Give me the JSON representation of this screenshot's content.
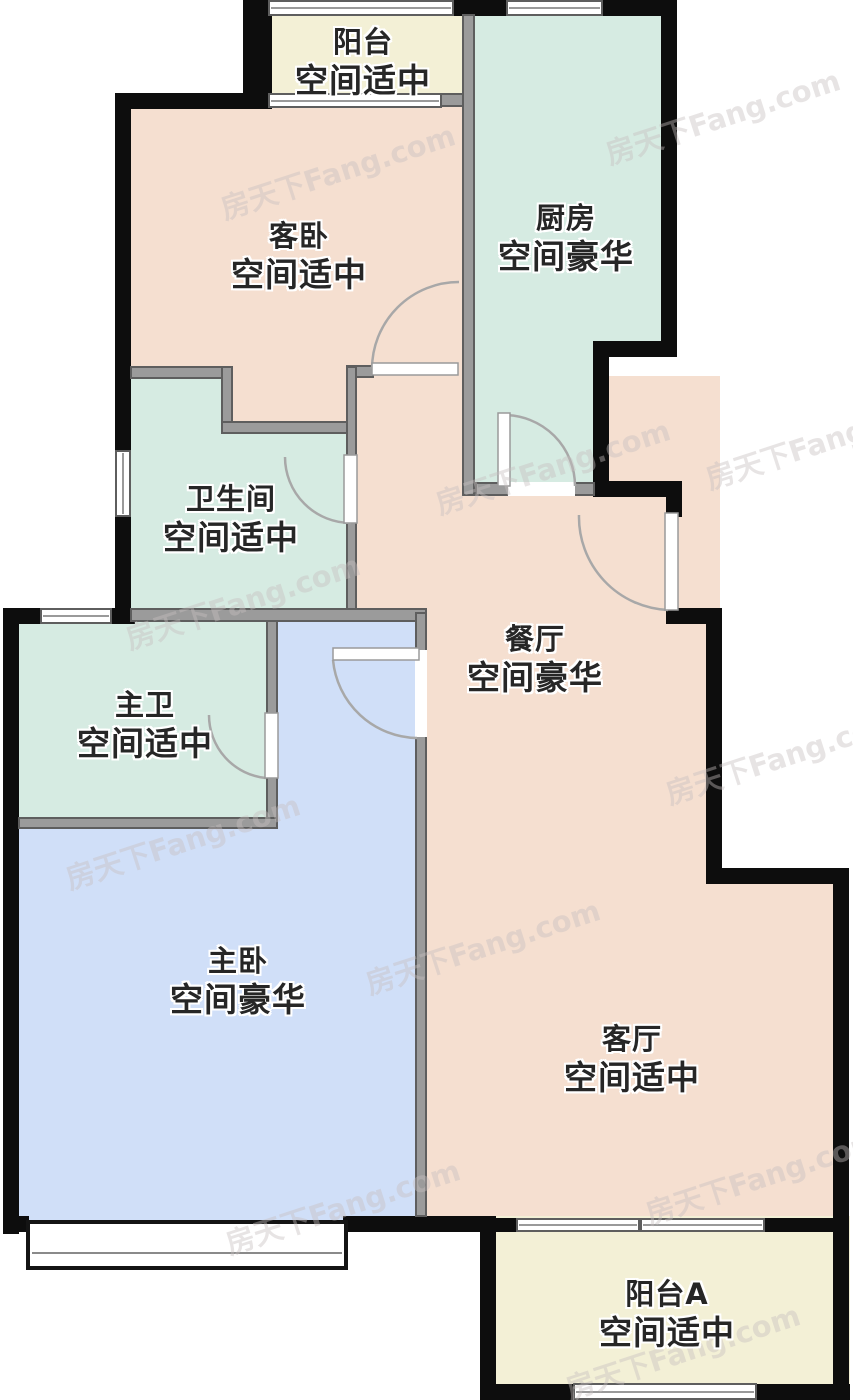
{
  "palette": {
    "peach": "#f5dfd0",
    "mint": "#d6ebe2",
    "cream": "#f3f0d6",
    "blue": "#d0dff8",
    "wall_exterior": "#0d0d0d",
    "wall_interior": "#9b9b9b",
    "label_text": "#262626",
    "door_arc": "#a8a8a8"
  },
  "canvas": {
    "width": 853,
    "height": 1400
  },
  "rooms": [
    {
      "id": "guest-bedroom",
      "color": "peach",
      "rects": [
        [
          115,
          93,
          360,
          401
        ]
      ],
      "label": {
        "l1": "客卧",
        "l2": "空间适中",
        "x": 299,
        "y": 257
      }
    },
    {
      "id": "dining-room",
      "color": "peach",
      "rects": [
        [
          347,
          376,
          373,
          506
        ],
        [
          415,
          612,
          305,
          620
        ]
      ],
      "label": {
        "l1": "餐厅",
        "l2": "空间豪华",
        "x": 535,
        "y": 660
      }
    },
    {
      "id": "living-room",
      "color": "peach",
      "rects": [
        [
          706,
          868,
          142,
          364
        ]
      ],
      "label": {
        "l1": "客厅",
        "l2": "空间适中",
        "x": 632,
        "y": 1060
      }
    },
    {
      "id": "master-bedroom",
      "color": "blue",
      "rects": [
        [
          18,
          608,
          408,
          624
        ]
      ],
      "label": {
        "l1": "主卧",
        "l2": "空间豪华",
        "x": 238,
        "y": 982
      }
    },
    {
      "id": "kitchen",
      "color": "mint",
      "rects": [
        [
          462,
          16,
          213,
          339
        ],
        [
          462,
          342,
          145,
          152
        ]
      ],
      "label": {
        "l1": "厨房",
        "l2": "空间豪华",
        "x": 566,
        "y": 239
      }
    },
    {
      "id": "bathroom",
      "color": "mint",
      "rects": [
        [
          115,
          366,
          117,
          71
        ],
        [
          115,
          427,
          242,
          195
        ]
      ],
      "label": {
        "l1": "卫生间",
        "l2": "空间适中",
        "x": 231,
        "y": 520
      }
    },
    {
      "id": "master-bathroom",
      "color": "mint",
      "rects": [
        [
          18,
          608,
          260,
          220
        ]
      ],
      "label": {
        "l1": "主卫",
        "l2": "空间适中",
        "x": 145,
        "y": 726
      }
    },
    {
      "id": "balcony",
      "color": "cream",
      "rects": [
        [
          245,
          0,
          230,
          107
        ]
      ],
      "label": {
        "l1": "阳台",
        "l2": "空间适中",
        "x": 363,
        "y": 63
      }
    },
    {
      "id": "balcony-a",
      "color": "cream",
      "rects": [
        [
          480,
          1216,
          370,
          184
        ]
      ],
      "label": {
        "l1": "阳台A",
        "l2": "空间适中",
        "x": 667,
        "y": 1315
      }
    }
  ],
  "walls": {
    "exterior": [
      [
        243,
        0,
        29,
        107
      ],
      [
        452,
        0,
        58,
        16
      ],
      [
        601,
        0,
        76,
        16
      ],
      [
        661,
        0,
        16,
        357
      ],
      [
        593,
        341,
        84,
        16
      ],
      [
        593,
        341,
        16,
        156
      ],
      [
        593,
        481,
        89,
        16
      ],
      [
        666,
        493,
        16,
        24
      ],
      [
        666,
        608,
        56,
        16
      ],
      [
        706,
        608,
        16,
        276
      ],
      [
        706,
        868,
        143,
        16
      ],
      [
        833,
        868,
        16,
        532
      ],
      [
        115,
        93,
        157,
        16
      ],
      [
        115,
        93,
        16,
        361
      ],
      [
        115,
        515,
        16,
        97
      ],
      [
        3,
        608,
        16,
        626
      ],
      [
        3,
        608,
        39,
        16
      ],
      [
        110,
        608,
        25,
        16
      ],
      [
        3,
        1216,
        26,
        16
      ],
      [
        343,
        1216,
        153,
        16
      ],
      [
        480,
        1216,
        16,
        184
      ],
      [
        480,
        1384,
        102,
        16
      ],
      [
        755,
        1384,
        95,
        16
      ],
      [
        495,
        1218,
        23,
        14
      ],
      [
        763,
        1218,
        72,
        14
      ]
    ],
    "interior": [
      [
        462,
        14,
        13,
        482
      ],
      [
        440,
        93,
        24,
        14
      ],
      [
        130,
        366,
        102,
        13
      ],
      [
        221,
        366,
        12,
        66
      ],
      [
        221,
        421,
        134,
        13
      ],
      [
        346,
        365,
        28,
        13
      ],
      [
        346,
        366,
        11,
        93
      ],
      [
        346,
        521,
        11,
        99
      ],
      [
        130,
        608,
        297,
        14
      ],
      [
        415,
        612,
        12,
        43
      ],
      [
        415,
        735,
        12,
        482
      ],
      [
        266,
        620,
        12,
        97
      ],
      [
        266,
        776,
        12,
        53
      ],
      [
        18,
        817,
        260,
        12
      ],
      [
        475,
        482,
        35,
        14
      ],
      [
        573,
        482,
        22,
        14
      ]
    ]
  },
  "windows": [
    {
      "rect": [
        268,
        0,
        186,
        16
      ],
      "v": false,
      "name": "balcony-top-window"
    },
    {
      "rect": [
        506,
        0,
        97,
        16
      ],
      "v": false,
      "name": "kitchen-top-window"
    },
    {
      "rect": [
        268,
        93,
        174,
        15
      ],
      "v": false,
      "name": "balcony-bedroom-window"
    },
    {
      "rect": [
        115,
        450,
        16,
        67
      ],
      "v": true,
      "name": "bathroom-side-window"
    },
    {
      "rect": [
        40,
        608,
        72,
        16
      ],
      "v": false,
      "name": "master-bathroom-window"
    },
    {
      "rect": [
        516,
        1218,
        124,
        14
      ],
      "v": false,
      "name": "living-balcony-window-left"
    },
    {
      "rect": [
        640,
        1218,
        125,
        14
      ],
      "v": false,
      "name": "living-balcony-window-right"
    },
    {
      "rect": [
        573,
        1383,
        184,
        17
      ],
      "v": false,
      "name": "balcony-a-bottom-window"
    }
  ],
  "bay_window": {
    "rect": [
      26,
      1220,
      322,
      50
    ],
    "name": "master-bedroom-bay-window"
  },
  "doors": [
    {
      "id": "guest-bedroom-door",
      "leaf": [
        372,
        363,
        86,
        12
      ],
      "arc": "M 372 369 A 87 87 0 0 1 459 282"
    },
    {
      "id": "kitchen-door",
      "leaf": [
        498,
        413,
        12,
        73
      ],
      "gap": [
        508,
        482,
        67,
        14
      ],
      "arc": "M 504 415 A 71 71 0 0 1 575 486"
    },
    {
      "id": "bathroom-door",
      "leaf": [
        344,
        455,
        13,
        68
      ],
      "arc": "M 285 457 A 66 66 0 0 0 351 523"
    },
    {
      "id": "entrance-door",
      "leaf": [
        665,
        513,
        13,
        97
      ],
      "arc": "M 579 515 A 93 93 0 0 0 668 610"
    },
    {
      "id": "master-bathroom-door",
      "leaf": [
        265,
        713,
        13,
        65
      ],
      "arc": "M 209 715 A 63 63 0 0 0 266 778"
    },
    {
      "id": "master-bedroom-door",
      "leaf": [
        333,
        648,
        86,
        12
      ],
      "gap": [
        415,
        650,
        12,
        87
      ],
      "arc": "M 333 660 A 86 86 0 0 0 417 738"
    }
  ],
  "watermark": {
    "text": "房天下Fang.com",
    "positions": [
      {
        "x": 215,
        "y": 150
      },
      {
        "x": 600,
        "y": 95
      },
      {
        "x": 430,
        "y": 445
      },
      {
        "x": 120,
        "y": 580
      },
      {
        "x": 660,
        "y": 735
      },
      {
        "x": 360,
        "y": 925
      },
      {
        "x": 60,
        "y": 820
      },
      {
        "x": 640,
        "y": 1155
      },
      {
        "x": 220,
        "y": 1185
      },
      {
        "x": 560,
        "y": 1330
      },
      {
        "x": 700,
        "y": 420
      }
    ]
  }
}
